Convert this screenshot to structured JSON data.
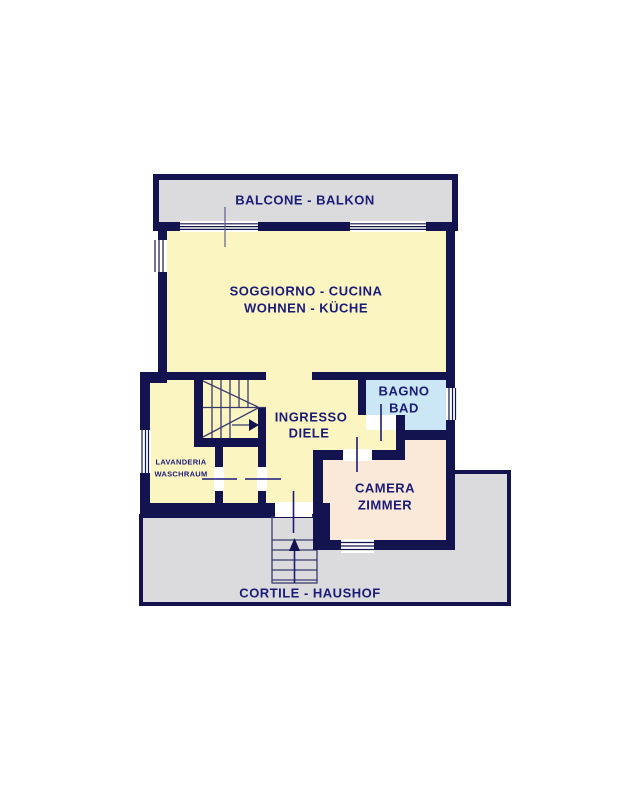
{
  "colors": {
    "wall_navy": "#131350",
    "label_text": "#1b1b78",
    "room_yellow": "#fbf5c2",
    "bathroom_blue": "#cbe6f5",
    "bedroom_peach": "#fae9d8",
    "paving_gray": "#dbdbdd",
    "window_white": "#ffffff"
  },
  "rooms": {
    "balcony": {
      "label": "BALCONE - BALKON"
    },
    "living_kitchen": {
      "label_it": "SOGGIORNO - CUCINA",
      "label_de": "WOHNEN - KÜCHE"
    },
    "hallway": {
      "label_it": "INGRESSO",
      "label_de": "DIELE"
    },
    "bathroom": {
      "label_it": "BAGNO",
      "label_de": "BAD"
    },
    "bedroom": {
      "label_it": "CAMERA",
      "label_de": "ZIMMER"
    },
    "laundry": {
      "label_it": "LAVANDERIA",
      "label_de": "WASCHRAUM"
    },
    "courtyard": {
      "label": "CORTILE - HAUSHOF"
    }
  }
}
